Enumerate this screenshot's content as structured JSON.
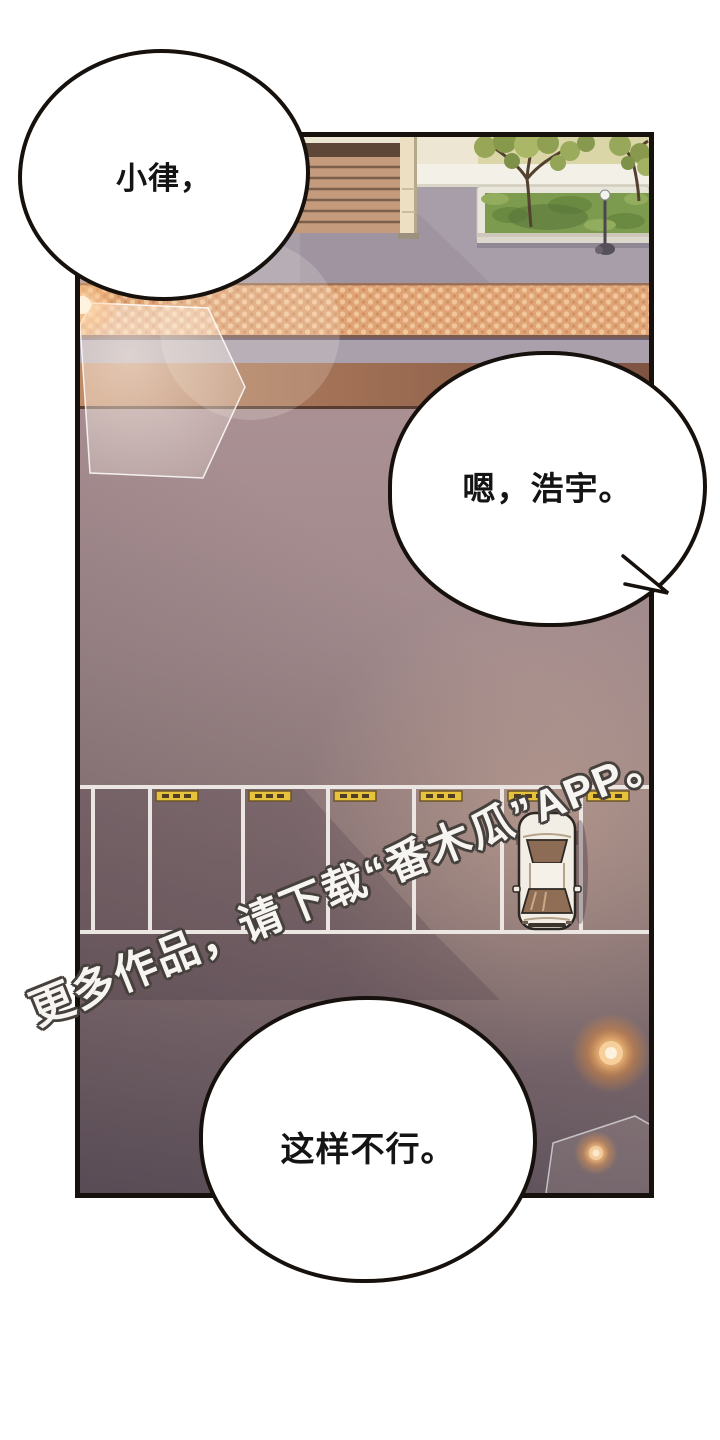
{
  "page": {
    "background": "#ffffff",
    "type": "webtoon-comic-panel"
  },
  "panel": {
    "border_color": "#17110d"
  },
  "speech_bubbles": [
    {
      "name": "bubble-top-left",
      "text": "小律，"
    },
    {
      "name": "bubble-middle-right",
      "text": "嗯，浩宇。"
    },
    {
      "name": "bubble-bottom",
      "text": "这样不行。"
    }
  ],
  "watermark": {
    "text": "更多作品，请下载“番木瓜”APP。",
    "fill": "#f7f5f2",
    "outline": "#46413d"
  },
  "scene": {
    "description": "overhead dusk view of a parking lot beside a sidewalk with stairs, tree planter, street lamp, brick crosswalk band, one parked cream car and two glowing orange lamps",
    "palette": {
      "wall_cream": "#ece6d2",
      "hedge_green": "#dbd6a8",
      "sidewalk_gray": "#a89ea9",
      "brick_band": "#e0a476",
      "brown_band": "#9a6a50",
      "asphalt": "#9a8588",
      "parking_line": "#ebe6e1",
      "wheel_stop_yellow": "#e7c23c",
      "car_body": "#f3eee5",
      "car_glass": "#906e55",
      "grass": "#7d9b4e",
      "lamp_glow": "#f3b269"
    }
  }
}
